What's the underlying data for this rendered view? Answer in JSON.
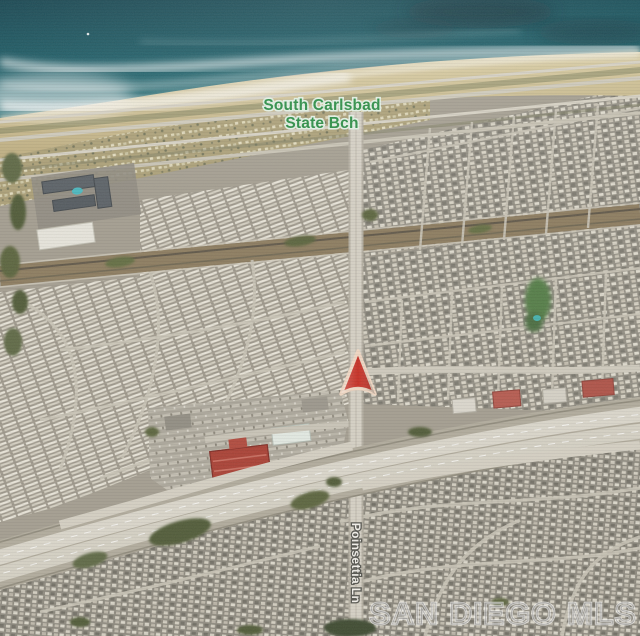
{
  "map": {
    "view_type": "satellite",
    "labels": {
      "beach_line1": "South Carlsbad",
      "beach_line2": "State Bch",
      "road": "Poinsettia Ln"
    },
    "watermark": "SAN DIEGO MLS",
    "marker": {
      "icon": "navigation-arrow-icon",
      "color": "#c6261b",
      "outline": "#f2d8c3"
    },
    "colors": {
      "ocean": "#11505c",
      "surf_foam": "#ffffff",
      "sand": "#cfc193",
      "beach_label_green": "#1f8a3c",
      "road_label_white": "#f5f3ee",
      "freeway_gray": "#dbd7cb"
    }
  }
}
